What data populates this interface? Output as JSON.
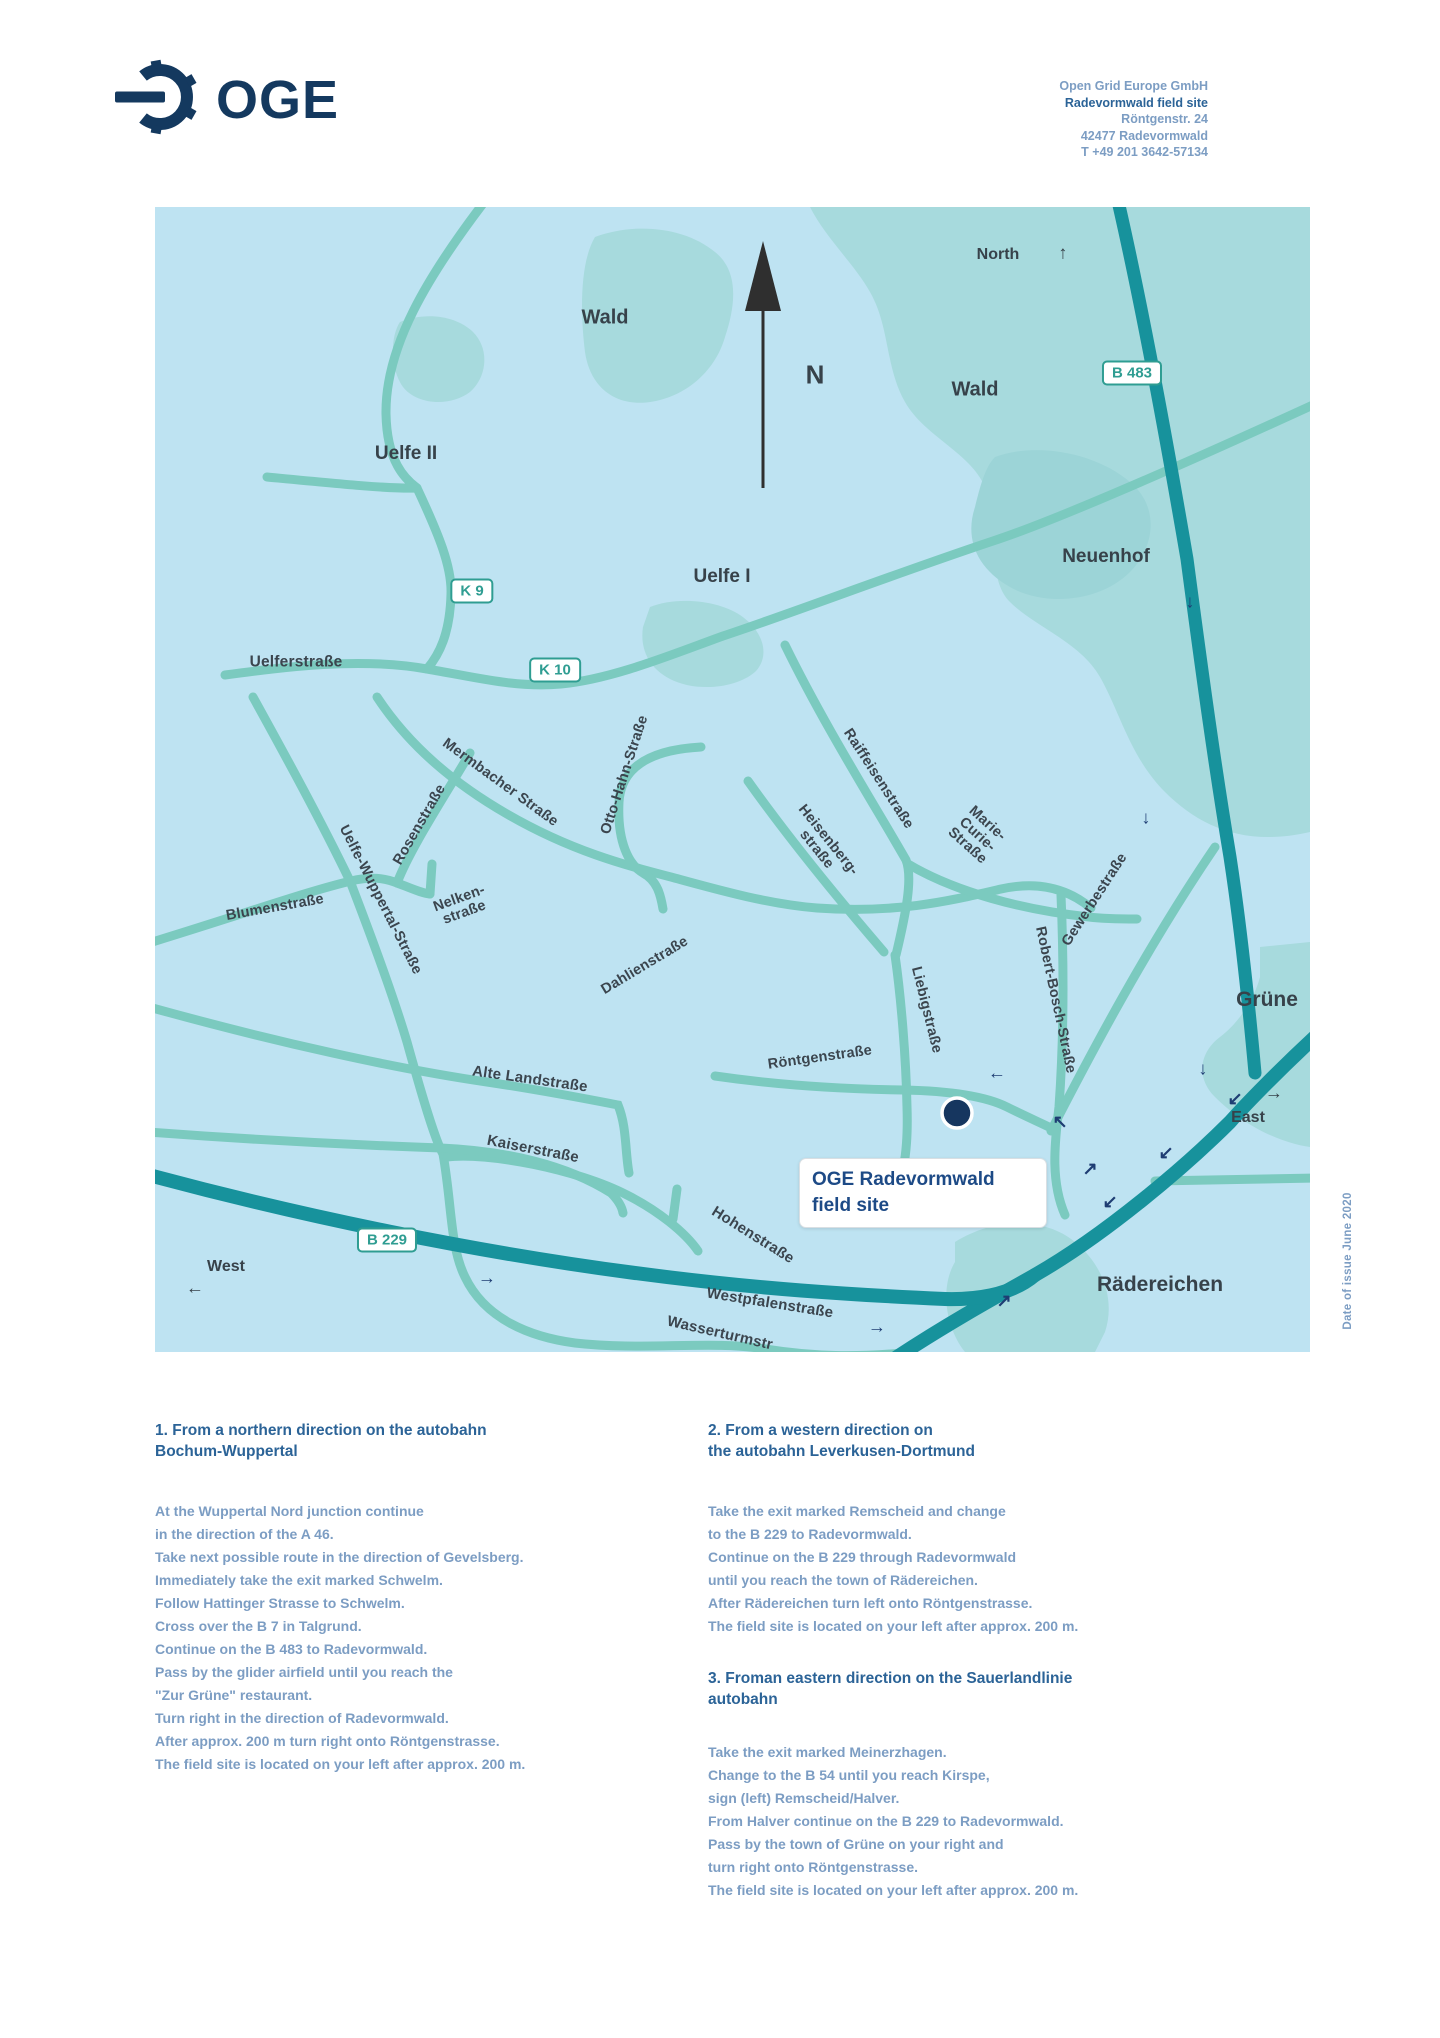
{
  "header": {
    "logo_text": "OGE",
    "address_lines": [
      "Open Grid Europe GmbH",
      "Radevormwald field site",
      "Röntgenstr. 24",
      "42477 Radevormwald",
      "T +49 201 3642-57134"
    ]
  },
  "map": {
    "colors": {
      "background": "#bee3f2",
      "forest": "#a7dadd",
      "road": "#7bcabf",
      "highway": "#17929c",
      "sign_teal": "#2f9d92",
      "label_dark": "#37424a",
      "arrow_navy": "#1e3d73",
      "site_navy": "#16365f"
    },
    "compass": {
      "n": "N",
      "north": "North"
    },
    "directions": {
      "east": "East",
      "west": "West"
    },
    "labels": {
      "wald_nw": "Wald",
      "wald_ne": "Wald",
      "uelfe2": "Uelfe II",
      "uelfe1": "Uelfe I",
      "neuenhof": "Neuenhof",
      "gruene": "Grüne",
      "raedereichen": "Rädereichen",
      "uelferstrasse": "Uelferstraße"
    },
    "signs": {
      "b483": "B 483",
      "k9": "K 9",
      "k10": "K 10",
      "b229": "B 229"
    },
    "streets": {
      "mermbacher": "Mermbacher Straße",
      "rosen": "Rosenstraße",
      "uelfe_wuppertal": "Uelfe-Wuppertal-Straße",
      "blumen": "Blumenstraße",
      "nelken1": "Nelken-",
      "nelken2": "straße",
      "otto_hahn": "Otto-Hahn-Straße",
      "dahlien": "Dahlienstraße",
      "raiffeisen": "Raiffeisenstraße",
      "heisenberg1": "Heisenberg-",
      "heisenberg2": "straße",
      "marie1": "Marie-",
      "marie2": "Curie-",
      "marie3": "Straße",
      "liebig": "Liebigstraße",
      "robert_bosch": "Robert-Bosch-Straße",
      "gewerbe": "Gewerbestraße",
      "roentgen": "Röntgenstraße",
      "alte_land": "Alte Landstraße",
      "kaiser": "Kaiserstraße",
      "hohen": "Hohenstraße",
      "westpfalen": "Westpfalenstraße",
      "wasserturm": "Wasserturmstr"
    },
    "arrow_glyphs": {
      "up": "↑",
      "down": "↓",
      "left": "←",
      "right": "→",
      "up_right": "↗",
      "down_left": "↙",
      "up_left": "↖"
    },
    "callout": {
      "line1": "OGE Radevormwald",
      "line2": "field site"
    }
  },
  "note": {
    "date_of_issue": "Date of issue June 2020"
  },
  "sections": [
    {
      "heading": [
        "1. From a northern direction on the autobahn",
        "Bochum-Wuppertal"
      ],
      "lines": [
        "At the Wuppertal Nord junction continue",
        "in the direction of the A 46.",
        "Take next possible route in the direction of Gevelsberg.",
        "Immediately take the exit marked Schwelm.",
        "Follow Hattinger Strasse to Schwelm.",
        "Cross over the B 7 in Talgrund.",
        "Continue on the B 483 to Radevormwald.",
        "Pass by the glider airfield until you reach the",
        "\"Zur Grüne\" restaurant.",
        "Turn right in the direction of Radevormwald.",
        "After approx. 200 m turn right onto Röntgenstrasse.",
        "The field site is located on your left after approx. 200 m."
      ]
    },
    {
      "heading": [
        "2. From a western direction on",
        "the autobahn Leverkusen-Dortmund"
      ],
      "lines": [
        "Take the exit marked Remscheid and change",
        "to the B 229 to Radevormwald.",
        "Continue on the B 229 through Radevormwald",
        "until you reach the town of Rädereichen.",
        "After Rädereichen turn left onto Röntgenstrasse.",
        "The field site is located on your left after approx. 200 m."
      ]
    },
    {
      "heading": [
        "3. Froman eastern direction on the Sauerlandlinie",
        "autobahn"
      ],
      "lines": [
        "Take the exit marked Meinerzhagen.",
        "Change to the B 54 until you reach Kirspe,",
        "sign (left) Remscheid/Halver.",
        "From Halver continue on the B 229 to Radevormwald.",
        "Pass by the town of Grüne on your right and",
        "turn right onto Röntgenstrasse.",
        "The field site is located on your left after approx. 200 m."
      ]
    }
  ]
}
